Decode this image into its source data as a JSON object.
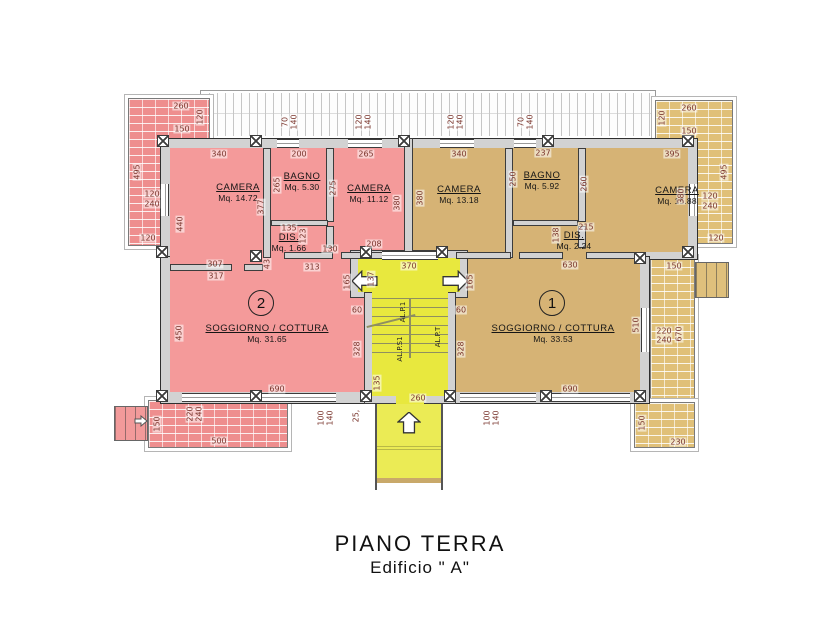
{
  "title": "PIANO TERRA",
  "subtitle": "Edificio \" A\"",
  "apartment_2": {
    "number": "2",
    "camera_1": {
      "name": "CAMERA",
      "area": "Mq. 14.72"
    },
    "bagno": {
      "name": "BAGNO",
      "area": "Mq. 5.30"
    },
    "camera_2": {
      "name": "CAMERA",
      "area": "Mq. 11.12"
    },
    "dis": {
      "name": "DIS.",
      "area": "Mq. 1.66"
    },
    "soggiorno": {
      "name": "SOGGIORNO / COTTURA",
      "area": "Mq. 31.65"
    }
  },
  "apartment_1": {
    "number": "1",
    "camera_1": {
      "name": "CAMERA",
      "area": "Mq. 13.18"
    },
    "bagno": {
      "name": "BAGNO",
      "area": "Mq. 5.92"
    },
    "camera_2": {
      "name": "CAMERA",
      "area": "Mq. 15.88"
    },
    "dis": {
      "name": "DIS.",
      "area": "Mq. 2.24"
    },
    "soggiorno": {
      "name": "SOGGIORNO / COTTURA",
      "area": "Mq. 33.53"
    }
  },
  "stairs": {
    "up_label": "AL.P.1",
    "basement_label": "AL.P.S1",
    "ground_label": "AL.P.T"
  },
  "colors": {
    "apartment_2_fill": "#f49a9a",
    "apartment_1_fill": "#d6b375",
    "stair_fill": "#e8e83e",
    "walkway_fill": "#ebeb55",
    "wall_fill": "#d2d2d2",
    "terrace_pink": "#ee8e8e",
    "terrace_tan": "#e0c078",
    "dim_text": "#7a352c"
  },
  "dim_labels": [
    [
      "260",
      181,
      106,
      0
    ],
    [
      "120",
      200,
      117,
      1
    ],
    [
      "150",
      182,
      129,
      0
    ],
    [
      "495",
      137,
      172,
      1
    ],
    [
      "120",
      152,
      194,
      0
    ],
    [
      "240",
      152,
      204,
      0
    ],
    [
      "120",
      148,
      238,
      0
    ],
    [
      "260",
      689,
      108,
      0
    ],
    [
      "120",
      662,
      118,
      1
    ],
    [
      "150",
      689,
      131,
      0
    ],
    [
      "495",
      724,
      172,
      1
    ],
    [
      "120",
      710,
      196,
      0
    ],
    [
      "240",
      710,
      206,
      0
    ],
    [
      "120",
      716,
      238,
      0
    ],
    [
      "70",
      285,
      122,
      1
    ],
    [
      "140",
      294,
      122,
      1
    ],
    [
      "120",
      359,
      122,
      1
    ],
    [
      "140",
      368,
      122,
      1
    ],
    [
      "120",
      451,
      122,
      1
    ],
    [
      "140",
      460,
      122,
      1
    ],
    [
      "70",
      521,
      122,
      1
    ],
    [
      "140",
      530,
      122,
      1
    ],
    [
      "340",
      219,
      154,
      0
    ],
    [
      "200",
      299,
      154,
      0
    ],
    [
      "265",
      366,
      154,
      0
    ],
    [
      "340",
      459,
      154,
      0
    ],
    [
      "237",
      543,
      153,
      0
    ],
    [
      "395",
      672,
      154,
      0
    ],
    [
      "440",
      180,
      224,
      1
    ],
    [
      "377",
      261,
      207,
      1
    ],
    [
      "265",
      277,
      185,
      1
    ],
    [
      "275",
      333,
      188,
      1
    ],
    [
      "380",
      397,
      203,
      1
    ],
    [
      "380",
      420,
      198,
      1
    ],
    [
      "250",
      513,
      179,
      1
    ],
    [
      "260",
      584,
      184,
      1
    ],
    [
      "380",
      681,
      196,
      1
    ],
    [
      "135",
      289,
      228,
      0
    ],
    [
      "123",
      303,
      236,
      1
    ],
    [
      "130",
      330,
      249,
      0
    ],
    [
      "208",
      374,
      244,
      0
    ],
    [
      "307",
      215,
      264,
      0
    ],
    [
      "317",
      216,
      276,
      0
    ],
    [
      "313",
      312,
      267,
      0
    ],
    [
      "43",
      267,
      264,
      1
    ],
    [
      "215",
      586,
      227,
      0
    ],
    [
      "138",
      556,
      235,
      1
    ],
    [
      "630",
      570,
      265,
      0
    ],
    [
      "450",
      179,
      333,
      1
    ],
    [
      "690",
      277,
      389,
      0
    ],
    [
      "690",
      570,
      389,
      0
    ],
    [
      "510",
      636,
      325,
      1
    ],
    [
      "370",
      409,
      266,
      0
    ],
    [
      "137",
      371,
      279,
      1
    ],
    [
      "165",
      347,
      282,
      1
    ],
    [
      "165",
      470,
      282,
      1
    ],
    [
      "60",
      357,
      310,
      0
    ],
    [
      "60",
      461,
      310,
      0
    ],
    [
      "328",
      357,
      349,
      1
    ],
    [
      "328",
      461,
      349,
      1
    ],
    [
      "135",
      377,
      383,
      1
    ],
    [
      "260",
      418,
      398,
      0
    ],
    [
      "25,",
      356,
      416,
      1
    ],
    [
      "100",
      321,
      418,
      1
    ],
    [
      "140",
      330,
      418,
      1
    ],
    [
      "100",
      487,
      418,
      1
    ],
    [
      "140",
      496,
      418,
      1
    ],
    [
      "150",
      157,
      424,
      1
    ],
    [
      "220",
      190,
      414,
      1
    ],
    [
      "240",
      199,
      414,
      1
    ],
    [
      "500",
      219,
      441,
      0
    ],
    [
      "150",
      674,
      266,
      0
    ],
    [
      "220",
      664,
      331,
      0
    ],
    [
      "240",
      664,
      340,
      0
    ],
    [
      "670",
      679,
      334,
      1
    ],
    [
      "150",
      642,
      423,
      1
    ],
    [
      "230",
      678,
      442,
      0
    ]
  ]
}
